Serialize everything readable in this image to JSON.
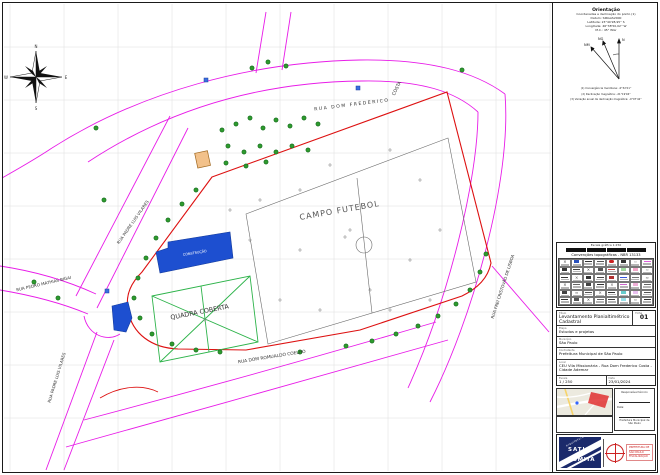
{
  "orientation": {
    "title": "Orientação",
    "lines": [
      "Coordenadas e declinação do ponto (1)",
      "Datum: SIRGAS2000",
      "Latitude: 23°40'28,95'' S",
      "Longitude: 46°38'50,02'' W",
      "M.C.: 45° WGr"
    ],
    "arrow_labels": {
      "n": "N",
      "ng": "NG",
      "nm": "NM"
    },
    "footnotes": [
      "(1) Convergência meridiana: -0°32'21''",
      "(2) Declinação magnética: -21°19'04''",
      "(3) Variação anual da declinação magnética: -0°07'42''"
    ]
  },
  "compass": {
    "n": "N",
    "e": "E",
    "s": "S",
    "w": "W"
  },
  "legend": {
    "scale_caption": "Escala gráfica 1:250",
    "title": "Convenções topográficas - NBR 13133",
    "cells": [
      {
        "c": "#333",
        "t": "x"
      },
      {
        "c": "#2a52be",
        "t": "sq"
      },
      {
        "c": "#333",
        "t": "ln"
      },
      {
        "c": "#555",
        "t": "ln"
      },
      {
        "c": "#cc2222",
        "t": "ov"
      },
      {
        "c": "#333",
        "t": "sq"
      },
      {
        "c": "#999",
        "t": "zz"
      },
      {
        "c": "#e060e0",
        "t": "ln"
      },
      {
        "c": "#333",
        "t": "sq"
      },
      {
        "c": "#444",
        "t": "ln"
      },
      {
        "c": "#333",
        "t": "x"
      },
      {
        "c": "#555",
        "t": "sq"
      },
      {
        "c": "#cc4444",
        "t": "ln"
      },
      {
        "c": "#9fd89f",
        "t": "sq"
      },
      {
        "c": "#f2a6c8",
        "t": "sq"
      },
      {
        "c": "#888",
        "t": "zz"
      },
      {
        "c": "#333",
        "t": "ln"
      },
      {
        "c": "#555",
        "t": "x"
      },
      {
        "c": "#333",
        "t": "sq"
      },
      {
        "c": "#444",
        "t": "ln"
      },
      {
        "c": "#b03030",
        "t": "sq"
      },
      {
        "c": "#3355dd",
        "t": "ln"
      },
      {
        "c": "#777",
        "t": "ln"
      },
      {
        "c": "#444",
        "t": "zz"
      },
      {
        "c": "#333",
        "t": "x"
      },
      {
        "c": "#666",
        "t": "ln"
      },
      {
        "c": "#444",
        "t": "sq"
      },
      {
        "c": "#333",
        "t": "ln"
      },
      {
        "c": "#555",
        "t": "x"
      },
      {
        "c": "#cc66cc",
        "t": "ln"
      },
      {
        "c": "#f0b0d8",
        "t": "sq"
      },
      {
        "c": "#666",
        "t": "ln"
      },
      {
        "c": "#444",
        "t": "sq"
      },
      {
        "c": "#333",
        "t": "zz"
      },
      {
        "c": "#555",
        "t": "ln"
      },
      {
        "c": "#444",
        "t": "x"
      },
      {
        "c": "#333",
        "t": "ln"
      },
      {
        "c": "#66cccc",
        "t": "sq"
      },
      {
        "c": "#e8c0f0",
        "t": "sq"
      },
      {
        "c": "#555",
        "t": "ln"
      },
      {
        "c": "#333",
        "t": "ln"
      },
      {
        "c": "#555",
        "t": "sq"
      },
      {
        "c": "#333",
        "t": "x"
      },
      {
        "c": "#666",
        "t": "ln"
      },
      {
        "c": "#444",
        "t": "ln"
      },
      {
        "c": "#99e0e8",
        "t": "sq"
      },
      {
        "c": "#555",
        "t": "zz"
      },
      {
        "c": "#333",
        "t": "ln"
      }
    ]
  },
  "titleblock": {
    "title_label": "Título",
    "title": "Levantamento Planialtimétrico Cadastral",
    "sheet_label": "Folha",
    "sheet": "01",
    "rows": [
      {
        "label": "Etapa",
        "value": "Estudos e projetos"
      },
      {
        "label": "Município",
        "value": "São Paulo"
      },
      {
        "label": "Contratante",
        "value": "Prefeitura Municipal de São Paulo"
      },
      {
        "label": "Local",
        "value": "CEU Vila Missionária - Rua Dom Frederico Costa - Cidade Ademar"
      }
    ],
    "scale_label": "Escala",
    "scale": "1 / 250",
    "date_label": "Data",
    "date": "23/01/2024"
  },
  "signatures": {
    "line1_label": "Responsável técnico",
    "note": "Data:",
    "line2_label": "Prefeitura Municipal de São Paulo"
  },
  "logo": {
    "diagonal": "arquitetura",
    "name_top": "SATIO",
    "name_bottom": "TOMITA",
    "stamp": [
      "PREFEITURA DE",
      "SÃO PAULO",
      "FISCALIZAÇÃO"
    ]
  },
  "map": {
    "colors": {
      "street": "#e81ce8",
      "boundary": "#dd1111",
      "court": "#2db34a",
      "building": "#1d4fd0",
      "tree": "#2e9b2e",
      "grid": "#dedede"
    },
    "labels": [
      {
        "text": "CAMPO FUTEBOL",
        "x": 340,
        "y": 213,
        "rot": -10,
        "size": 8,
        "color": "#555",
        "ls": 1
      },
      {
        "text": "QUADRA COBERTA",
        "x": 200,
        "y": 314,
        "rot": -11,
        "size": 6.4,
        "color": "#333"
      },
      {
        "text": "CONSTRUÇÃO",
        "x": 195,
        "y": 254,
        "rot": -9,
        "size": 3.4,
        "color": "#ffffff"
      },
      {
        "text": "RUA DOM FREDERICO",
        "x": 352,
        "y": 106,
        "rot": -7,
        "size": 4.6,
        "color": "#333",
        "ls": 1.5
      },
      {
        "text": "COSTA",
        "x": 398,
        "y": 89,
        "rot": -64,
        "size": 4.6,
        "color": "#333"
      },
      {
        "text": "RUA FREI CRISTOVÃO DE LISBOA",
        "x": 504,
        "y": 287,
        "rot": -72,
        "size": 4.1,
        "color": "#333"
      },
      {
        "text": "RUA DOM ROMUALDO COELHO",
        "x": 272,
        "y": 358,
        "rot": -9,
        "size": 4.4,
        "color": "#333"
      },
      {
        "text": "RUA PEDRO MATHIAS BIGAI",
        "x": 44,
        "y": 285,
        "rot": -13,
        "size": 4.1,
        "color": "#333"
      },
      {
        "text": "RUA PADRE LUIS VILARES",
        "x": 134,
        "y": 223,
        "rot": -55,
        "size": 4.1,
        "color": "#333"
      },
      {
        "text": "RUA PADRE LUIS VILARES",
        "x": 58,
        "y": 378,
        "rot": -73,
        "size": 4.1,
        "color": "#333"
      }
    ],
    "trees": [
      [
        222,
        130
      ],
      [
        236,
        124
      ],
      [
        250,
        118
      ],
      [
        263,
        128
      ],
      [
        276,
        120
      ],
      [
        290,
        126
      ],
      [
        304,
        118
      ],
      [
        318,
        124
      ],
      [
        228,
        146
      ],
      [
        244,
        152
      ],
      [
        260,
        146
      ],
      [
        276,
        152
      ],
      [
        292,
        146
      ],
      [
        308,
        150
      ],
      [
        226,
        163
      ],
      [
        246,
        166
      ],
      [
        266,
        162
      ],
      [
        196,
        190
      ],
      [
        182,
        204
      ],
      [
        168,
        220
      ],
      [
        156,
        238
      ],
      [
        146,
        258
      ],
      [
        138,
        278
      ],
      [
        134,
        298
      ],
      [
        140,
        318
      ],
      [
        152,
        334
      ],
      [
        172,
        344
      ],
      [
        196,
        350
      ],
      [
        220,
        352
      ],
      [
        486,
        254
      ],
      [
        480,
        272
      ],
      [
        470,
        290
      ],
      [
        456,
        304
      ],
      [
        438,
        316
      ],
      [
        418,
        326
      ],
      [
        396,
        334
      ],
      [
        372,
        341
      ],
      [
        346,
        346
      ],
      [
        300,
        352
      ],
      [
        252,
        68
      ],
      [
        268,
        62
      ],
      [
        286,
        66
      ],
      [
        462,
        70
      ],
      [
        96,
        128
      ],
      [
        58,
        298
      ],
      [
        34,
        282
      ],
      [
        104,
        200
      ]
    ],
    "crosses": [
      [
        260,
        200
      ],
      [
        300,
        190
      ],
      [
        330,
        165
      ],
      [
        390,
        150
      ],
      [
        420,
        180
      ],
      [
        440,
        230
      ],
      [
        410,
        260
      ],
      [
        370,
        290
      ],
      [
        320,
        310
      ],
      [
        280,
        300
      ],
      [
        250,
        240
      ],
      [
        230,
        210
      ],
      [
        300,
        250
      ],
      [
        350,
        230
      ],
      [
        390,
        310
      ],
      [
        430,
        300
      ],
      [
        205,
        320
      ],
      [
        345,
        237
      ]
    ],
    "utilities": [
      [
        107,
        291
      ],
      [
        358,
        88
      ],
      [
        206,
        80
      ]
    ]
  }
}
